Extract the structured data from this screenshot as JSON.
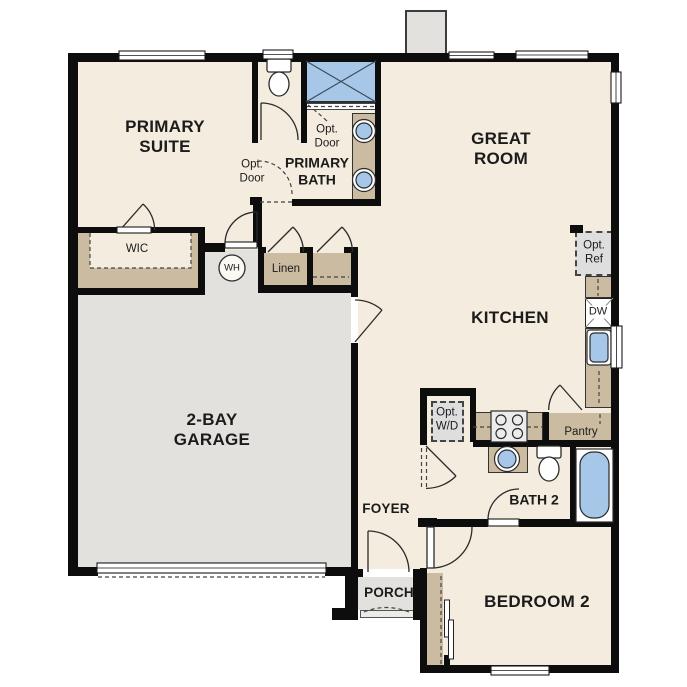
{
  "title": "Single-story floor plan",
  "colors": {
    "floor": "#f4ecdf",
    "garage_floor": "#e3e1dd",
    "cabinet_tan": "#cbbca1",
    "fixture_blue": "#a6c7e7",
    "wall_black": "#0d0d0d",
    "optional_box_gray": "#dedede"
  },
  "rooms": {
    "primary_suite": "PRIMARY SUITE",
    "primary_bath": "PRIMARY BATH",
    "great_room": "GREAT ROOM",
    "kitchen": "KITCHEN",
    "garage": "2-BAY GARAGE",
    "wic": "WIC",
    "linen": "Linen",
    "pantry": "Pantry",
    "foyer": "FOYER",
    "porch": "PORCH",
    "bath2": "BATH 2",
    "bedroom2": "BEDROOM 2"
  },
  "annotations": {
    "wh": "WH",
    "dw": "DW",
    "opt_ref": "Opt. Ref",
    "opt_wd": "Opt. W/D",
    "opt_door_shower": "Opt. Door",
    "opt_door_bath": "Opt. Door"
  },
  "icons": {
    "toilet": "toilet-icon",
    "sink": "sink-icon",
    "tub": "bathtub-icon",
    "shower": "shower-icon",
    "stove": "stove-icon",
    "water_heater": "water-heater-icon",
    "dishwasher": "dishwasher-icon",
    "window": "window-icon",
    "door_swing": "door-swing-icon"
  }
}
